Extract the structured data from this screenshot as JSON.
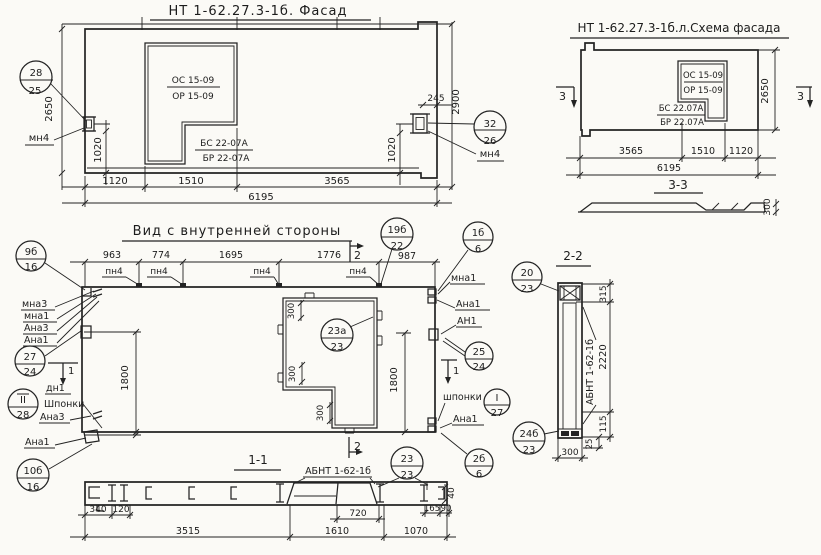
{
  "sheet": {
    "name": "panel-blueprint"
  },
  "facade": {
    "title": "НТ 1-62.27.3-1б. Фасад",
    "win_os": "ОС 15-09",
    "win_or": "ОР 15-09",
    "win_bs": "БС 22-07А",
    "win_br": "БР 22-07А",
    "callout_l_top": "28",
    "callout_l_bot": "25",
    "callout_r_top": "32",
    "callout_r_bot": "26",
    "anchor_l": "мн4",
    "anchor_r": "мн4",
    "dim_2650": "2650",
    "dim_1020_l": "1020",
    "dim_245": "245",
    "dim_2900": "2900",
    "dim_1020_r": "1020",
    "dim_1120": "1120",
    "dim_1510": "1510",
    "dim_3565": "3565",
    "dim_6195": "6195"
  },
  "schema": {
    "title": "НТ 1-62.27.3-1б.л.Схема фасада",
    "win_os": "ОС 15-09",
    "win_or": "ОР 15-09",
    "win_bs": "БС 22.07А",
    "win_br": "БР 22.07А",
    "sec3": "3",
    "dim_2650": "2650",
    "dim_3565": "3565",
    "dim_1510": "1510",
    "dim_1120": "1120",
    "dim_6195": "6195",
    "sec33_title": "3-3",
    "dim_300": "300"
  },
  "inner": {
    "title": "Вид с внутренней стороны",
    "dim_963": "963",
    "dim_774": "774",
    "dim_1695": "1695",
    "dim_1776": "1776",
    "dim_987": "987",
    "pn4": "пн4",
    "sec2": "2",
    "sec1": "1",
    "c9b_top": "9б",
    "c9b_bot": "16",
    "c19b_top": "19б",
    "c19b_bot": "22",
    "c1b_top": "1б",
    "c1b_bot": "6",
    "c20_top": "20",
    "c20_bot": "23",
    "c27_top": "27",
    "c27_bot": "24",
    "cII_top": "II",
    "cII_bot": "28",
    "c10b_top": "10б",
    "c10b_bot": "16",
    "c23a_top": "23а",
    "c23a_bot": "23",
    "c25_top": "25",
    "c25_bot": "24",
    "cI_top": "I",
    "cI_bot": "27",
    "c2b_top": "2б",
    "c2b_bot": "6",
    "c24b_top": "24б",
    "c24b_bot": "23",
    "mna3": "мна3",
    "mna1": "мна1",
    "ana3": "Ана3",
    "ana1": "Ана1",
    "dn1": "дн1",
    "shponki_l": "Шпонки",
    "ana3_b": "Ана3",
    "ana1_b": "Ана1",
    "r_mna1": "мна1",
    "r_ana1": "Ана1",
    "r_an1": "АН1",
    "r_shponki": "шпонки",
    "r_ana1_b": "Ана1",
    "dim_300": "300",
    "dim_1800": "1800"
  },
  "sec11": {
    "title": "1-1",
    "abnt": "АБНТ 1-62-1б",
    "c23_top": "23",
    "c23_bot": "23",
    "dim_340": "340",
    "dim_120": "120",
    "dim_720": "720",
    "dim_165": "165",
    "dim_90": "90",
    "dim_40": "40",
    "dim_3515": "3515",
    "dim_1610": "1610",
    "dim_1070": "1070"
  },
  "sec22": {
    "title": "2-2",
    "abnt": "АБНТ 1-62-1б",
    "dim_315": "315",
    "dim_2220": "2220",
    "dim_115": "115",
    "dim_25": "25",
    "dim_300": "300"
  }
}
